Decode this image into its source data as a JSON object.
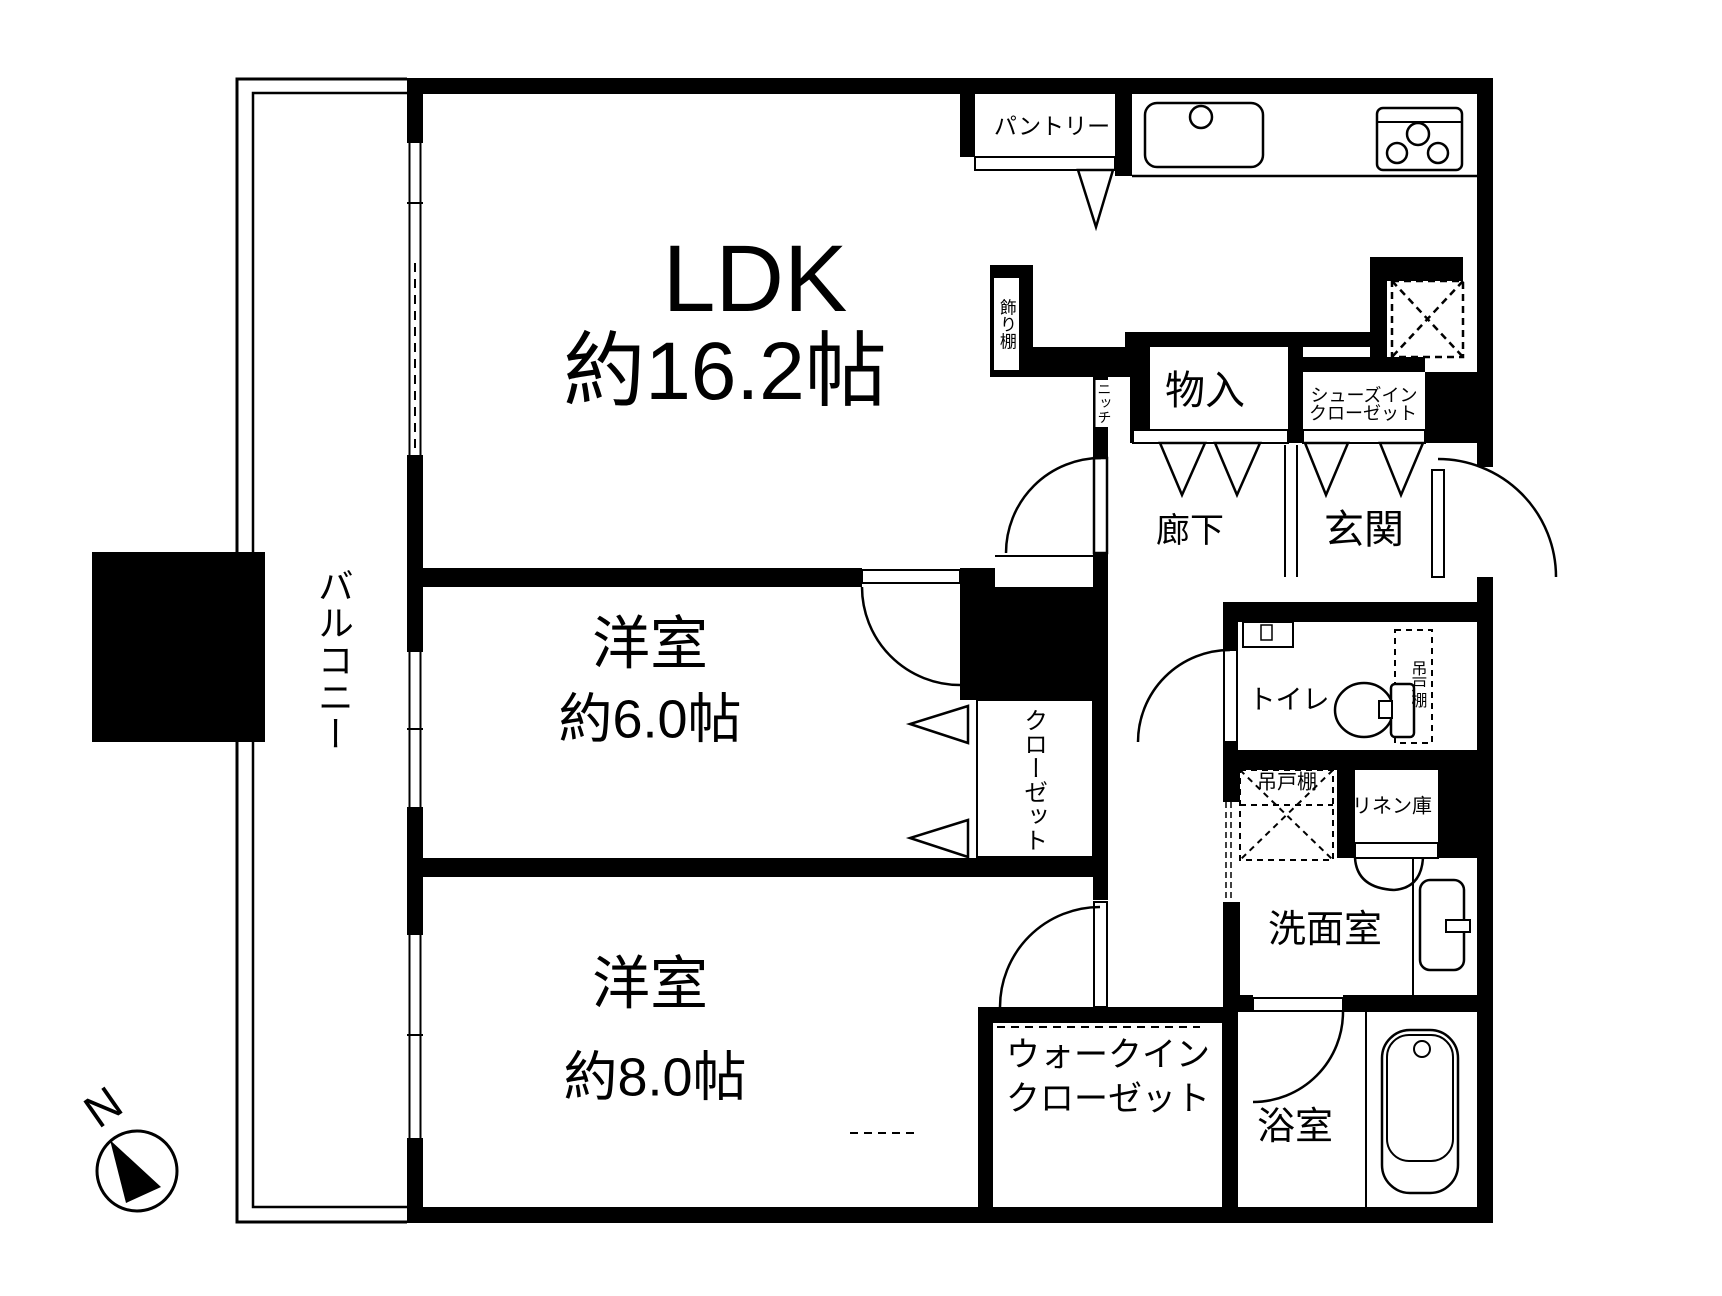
{
  "colors": {
    "wall": "#000000",
    "background": "#ffffff",
    "line": "#000000"
  },
  "labels": {
    "ldk_name": "LDK",
    "ldk_size": "約16.2帖",
    "pantry": "パントリー",
    "kazaridana": "飾り棚",
    "niche": "ニッチ",
    "monoire": "物入",
    "sic_line1": "シューズイン",
    "sic_line2": "クローゼット",
    "hallway": "廊下",
    "entrance": "玄関",
    "balcony": "バルコニー",
    "west6_name": "洋室",
    "west6_size": "約6.0帖",
    "closet": "クローゼット",
    "toilet": "トイレ",
    "hanging_cupboard_toilet": "吊戸棚",
    "hanging_cupboard_wash": "吊戸棚",
    "linen": "リネン庫",
    "washroom": "洗面室",
    "west8_name": "洋室",
    "west8_size": "約8.0帖",
    "wic_line1": "ウォークイン",
    "wic_line2": "クローゼット",
    "bath": "浴室",
    "compass_north": "N"
  }
}
